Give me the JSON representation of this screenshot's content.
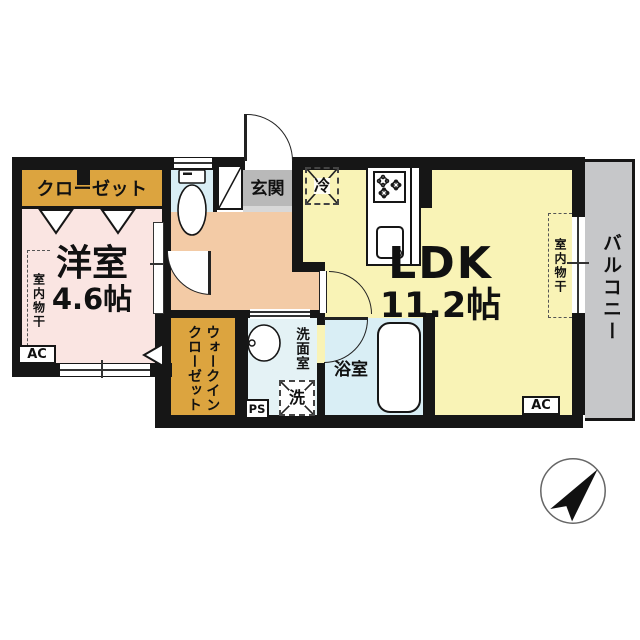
{
  "plan": {
    "rooms": {
      "closet": {
        "label": "クローゼット"
      },
      "western_room": {
        "name": "洋室",
        "size": "4.6帖"
      },
      "ldk": {
        "name": "LDK",
        "size": "11.2帖"
      },
      "entrance": {
        "label": "玄関"
      },
      "walk_in_closet": {
        "label": "ウォークイン\nクローゼット"
      },
      "washroom": {
        "label": "洗面室"
      },
      "bathroom": {
        "label": "浴室"
      },
      "balcony": {
        "label": "バルコニー"
      }
    },
    "fixtures": {
      "refrigerator": {
        "label": "冷"
      },
      "washer": {
        "label": "洗"
      },
      "pipe_space": {
        "label": "PS"
      },
      "ac_western_room": {
        "label": "AC"
      },
      "ac_ldk": {
        "label": "AC"
      },
      "indoor_drying_western_room": {
        "label": "室内物干"
      },
      "indoor_drying_ldk": {
        "label": "室内物干"
      }
    },
    "colors": {
      "wall": "#161616",
      "western_room_floor": "#fae5e2",
      "ldk_floor": "#f9f3b6",
      "closet_floor": "#dca43f",
      "hallway_floor": "#f3cba6",
      "bath_toilet_floor": "#d9eef5",
      "washroom_floor": "#e4f2f5",
      "entrance_tile": "#b9b9b9",
      "entrance_step": "#d8d8d8",
      "balcony_floor": "#c6c7c9"
    }
  }
}
